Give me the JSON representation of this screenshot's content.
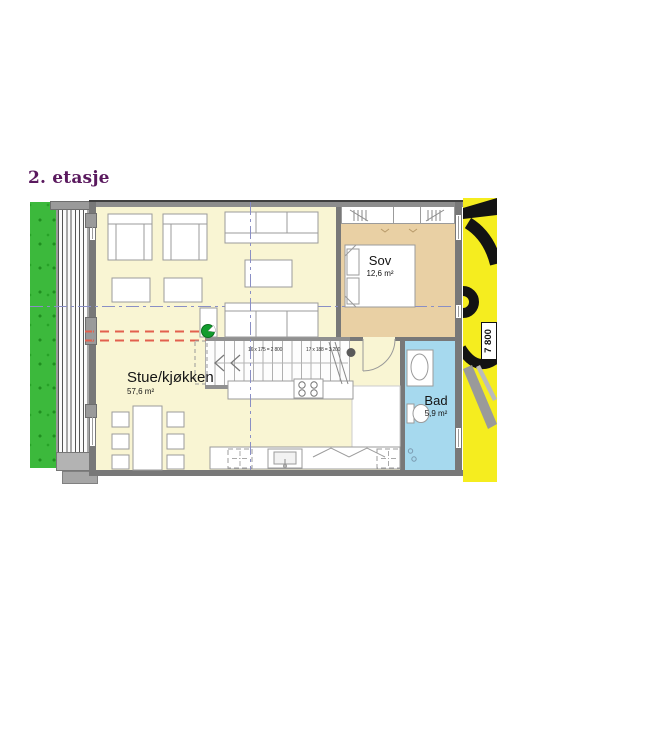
{
  "title": "2. etasje",
  "rooms": {
    "living": {
      "name": "Stue/kjøkken",
      "area": "57,6 m²"
    },
    "bedroom": {
      "name": "Sov",
      "area": "12,6 m²"
    },
    "bathroom": {
      "name": "Bad",
      "area": "5,9 m²"
    }
  },
  "stairs": {
    "annotation_left": "16 x 175 = 2 800",
    "annotation_right": "17 x 188 = 3 200"
  },
  "dimensions": {
    "width_label": "7 800"
  },
  "colors": {
    "floor": "#f9f5d3",
    "bedroom_floor": "#e9d0a4",
    "bathroom_floor": "#a6d9ee",
    "lawn": "#3cb93c",
    "highlight_strip": "#f5ed1f",
    "title_text": "#5a195e",
    "section_line": "#8a8fc5",
    "overhang_line": "#e2604e"
  }
}
